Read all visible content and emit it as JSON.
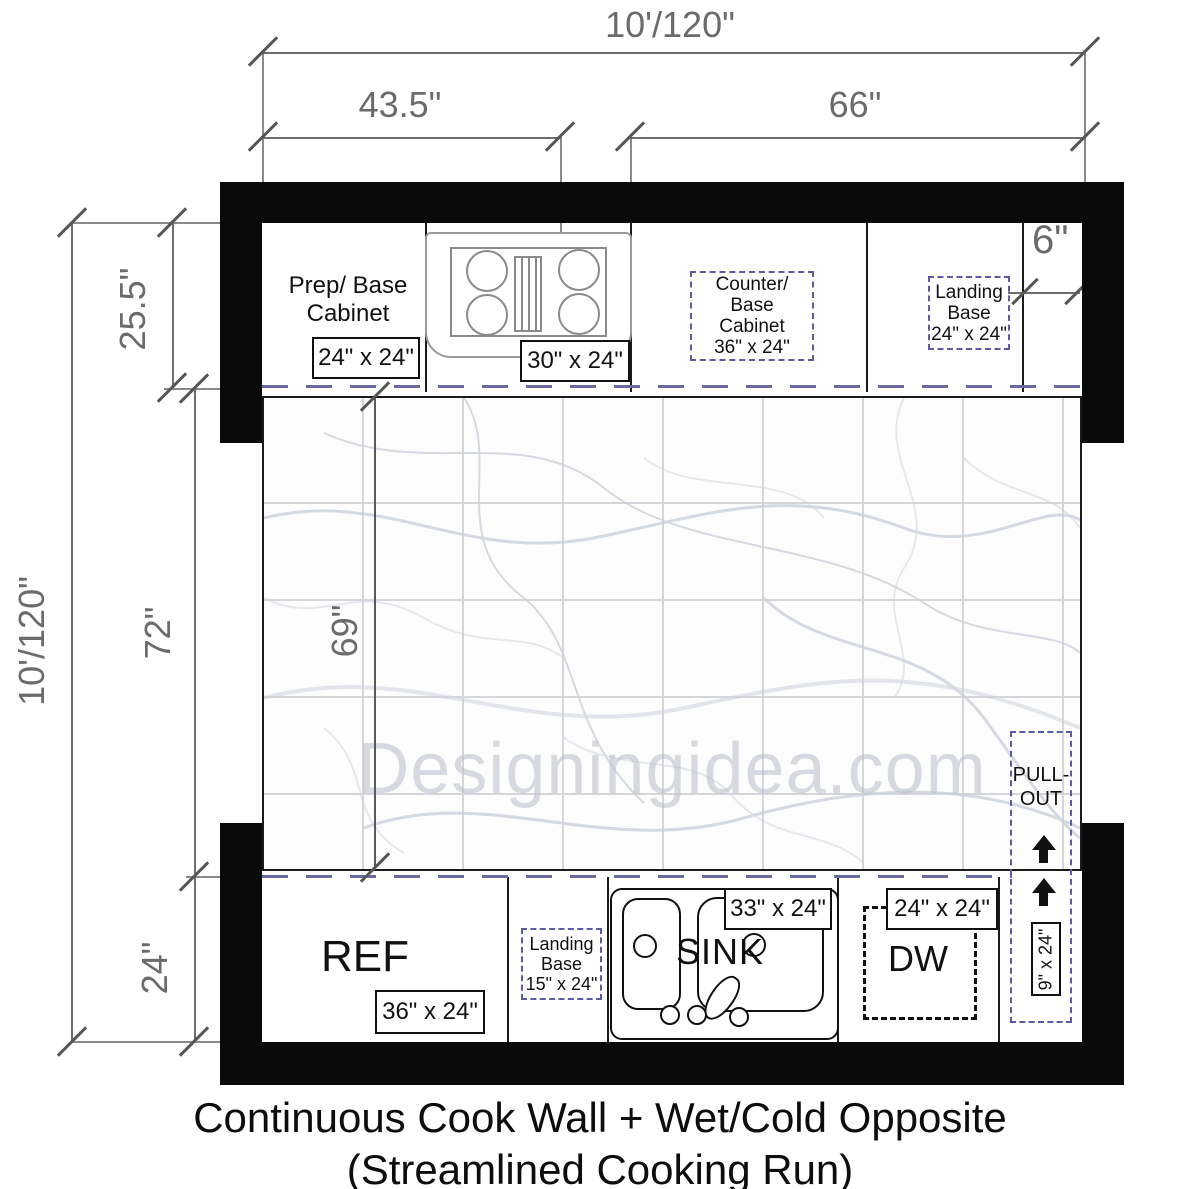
{
  "title": {
    "line1": "Continuous Cook Wall + Wet/Cold Opposite",
    "line2": "(Streamlined Cooking Run)"
  },
  "watermark": "Designingidea.com",
  "dimensions": {
    "top_total": "10'/120\"",
    "left_total": "10'/120\"",
    "top_left_run": "43.5\"",
    "top_right_run": "66\"",
    "top_counter_depth": "25.5\"",
    "floor_clearance": "72\"",
    "floor_inner_clearance": "69\"",
    "bottom_counter_depth": "24\"",
    "right_gap": "6\""
  },
  "top_run": {
    "prep": {
      "label_line1": "Prep/ Base",
      "label_line2": "Cabinet",
      "size": "24\" x 24\""
    },
    "cooktop": {
      "size": "30\" x 24\""
    },
    "counter": {
      "lines": [
        "Counter/",
        "Base",
        "Cabinet",
        "36\" x 24\""
      ]
    },
    "landing": {
      "lines": [
        "Landing",
        "Base",
        "24\" x 24\""
      ]
    }
  },
  "bottom_run": {
    "ref": {
      "label": "REF",
      "size": "36\" x 24\""
    },
    "landing": {
      "lines": [
        "Landing",
        "Base",
        "15\" x 24\""
      ]
    },
    "sink": {
      "label": "SINK",
      "size": "33\" x 24\""
    },
    "dishwasher": {
      "label": "DW",
      "size": "24\" x 24\""
    },
    "pullout": {
      "label_line1": "PULL-",
      "label_line2": "OUT",
      "size": "9\" x 24\""
    }
  },
  "colors": {
    "wall": "#0a0a0a",
    "dimension": "#6b6b6b",
    "counter_edge_dash": "#6a6aa2",
    "planned_cabinet_dash": "#5c5ca6",
    "floor_grid": "#d6d6da",
    "watermark": "#b9bdca"
  }
}
